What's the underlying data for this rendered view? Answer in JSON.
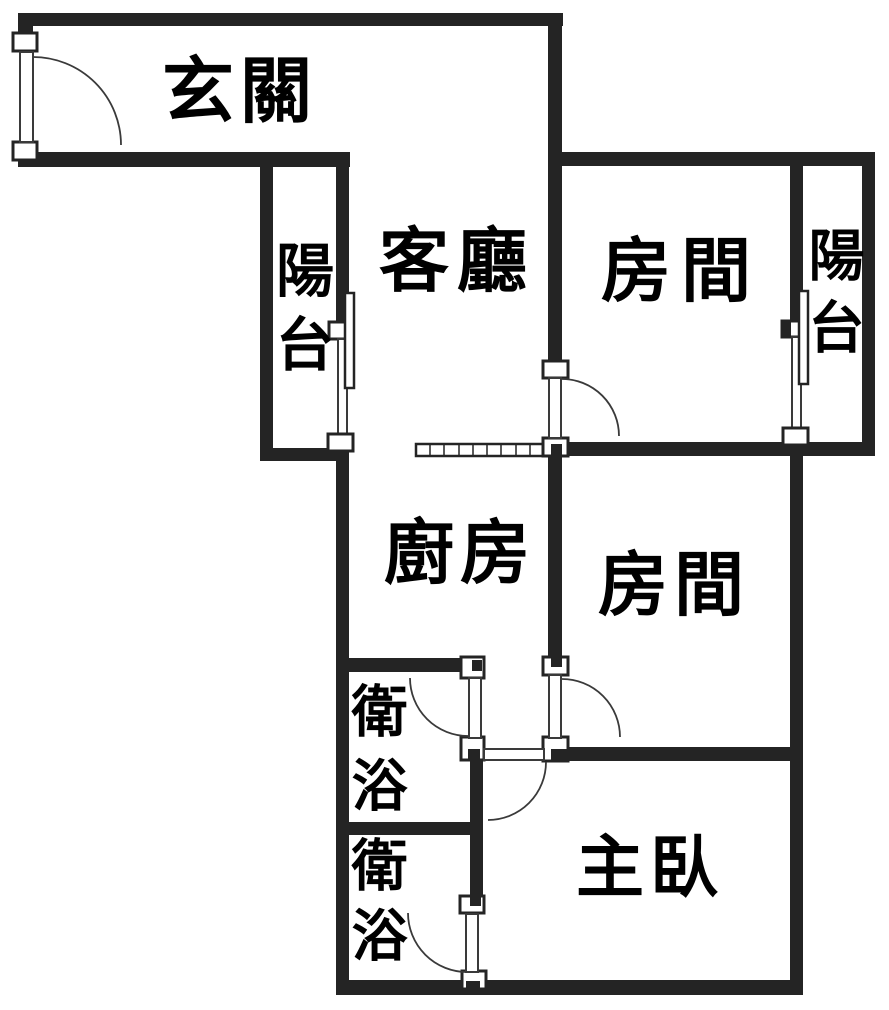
{
  "title": "apartment floor plan",
  "rooms": [
    {
      "id": "entry",
      "label": "玄關",
      "orientation": "horizontal"
    },
    {
      "id": "balcony-left",
      "label": "陽台",
      "orientation": "vertical"
    },
    {
      "id": "living-room",
      "label": "客廳",
      "orientation": "horizontal"
    },
    {
      "id": "bedroom-1",
      "label": "房間",
      "orientation": "horizontal"
    },
    {
      "id": "balcony-right",
      "label": "陽台",
      "orientation": "vertical"
    },
    {
      "id": "kitchen",
      "label": "廚房",
      "orientation": "horizontal"
    },
    {
      "id": "bedroom-2",
      "label": "房間",
      "orientation": "horizontal"
    },
    {
      "id": "bathroom-1",
      "label": "衛浴",
      "orientation": "vertical"
    },
    {
      "id": "bathroom-2",
      "label": "衛浴",
      "orientation": "vertical"
    },
    {
      "id": "master-bedroom",
      "label": "主臥",
      "orientation": "horizontal"
    }
  ],
  "colors": {
    "wall": "#242424",
    "line": "#3a3a3a",
    "text": "#000000",
    "background": "#ffffff"
  }
}
